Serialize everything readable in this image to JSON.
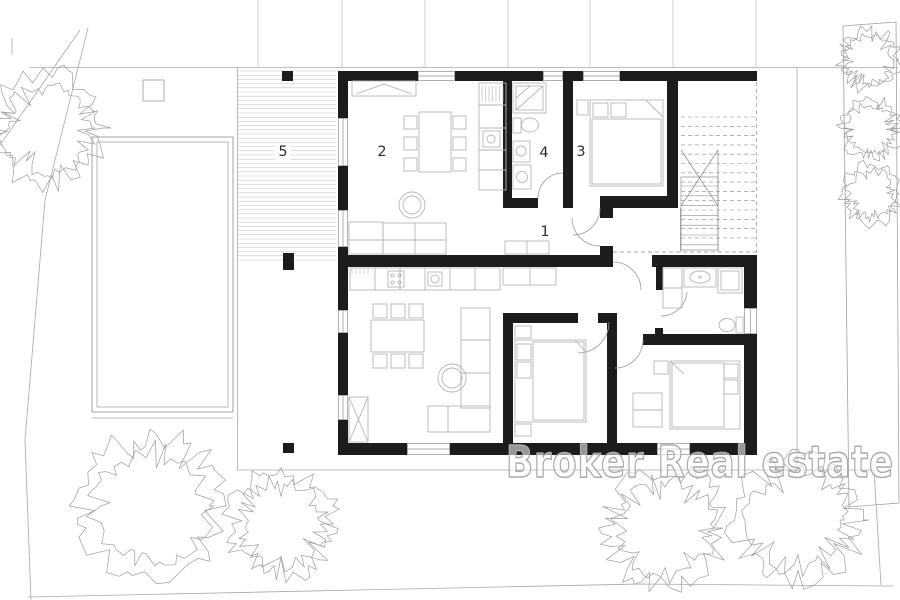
{
  "watermark": {
    "text": "Broker Real estate"
  },
  "rooms": {
    "r1": {
      "label": "1",
      "name": "hall"
    },
    "r2": {
      "label": "2",
      "name": "living-dining-kitchen"
    },
    "r3": {
      "label": "3",
      "name": "bedroom"
    },
    "r4": {
      "label": "4",
      "name": "bathroom"
    },
    "r5": {
      "label": "5",
      "name": "terrace-deck"
    }
  },
  "colors": {
    "wall": "#1c1c1c",
    "thin_line": "#9a9a9a",
    "furniture": "#b5b5b5",
    "hatch": "#c3c3c3",
    "stairs": "#8c8c8c",
    "tree": "#9c9c9c",
    "watermark_outline": "#ababab",
    "label": "#2e2e2e"
  }
}
